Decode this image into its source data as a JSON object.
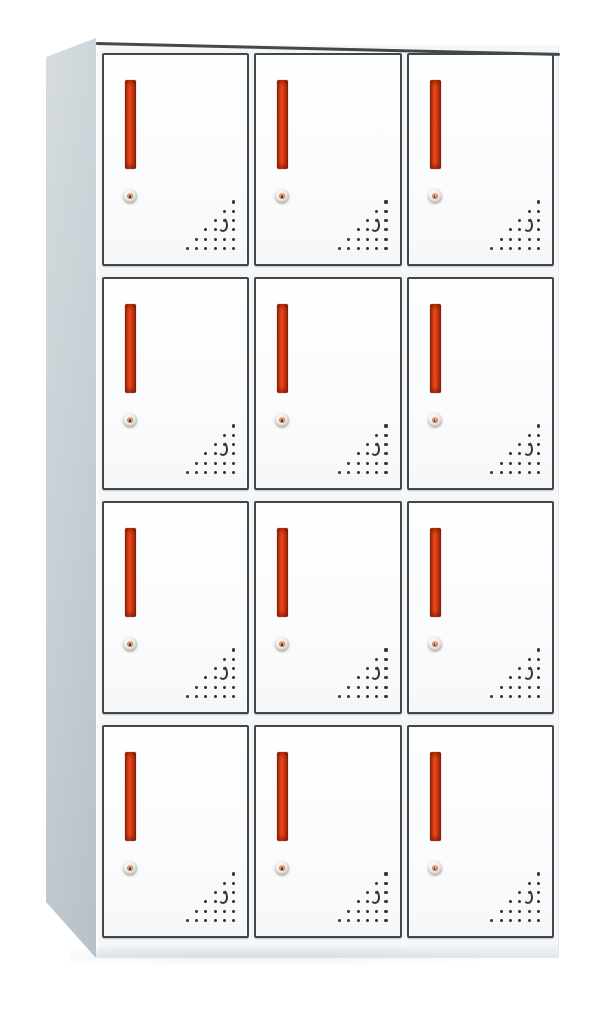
{
  "scene": {
    "subject": "12-door steel locker cabinet",
    "view": "three-quarter product photo, left side visible",
    "background_color": "#ffffff"
  },
  "cabinet": {
    "grid": {
      "rows": 4,
      "columns": 3,
      "door_count": 12
    },
    "colors": {
      "front_frame": "#f4f6f7",
      "side_panel": "#c5ced3",
      "side_panel_light": "#d6dce0",
      "top_edge": "#44484c",
      "door_face": "#fbfcfd",
      "door_border": "#43474b",
      "handle_bright": "#e8491c",
      "handle_mid": "#c63711",
      "handle_dark": "#8f2409",
      "lock_base": "#ece9e3",
      "lock_accent": "#c4633e",
      "vent_dot": "#33373a"
    },
    "door_features": {
      "handle": "vertical red grip bar",
      "lock": "round cam lock below handle",
      "vent": {
        "pattern": "right-angled triangle of perforation dots, bottom-right corner",
        "rows": 6,
        "crescent_slot": {
          "row_from_top": 4,
          "col_from_right": 2
        }
      }
    }
  }
}
